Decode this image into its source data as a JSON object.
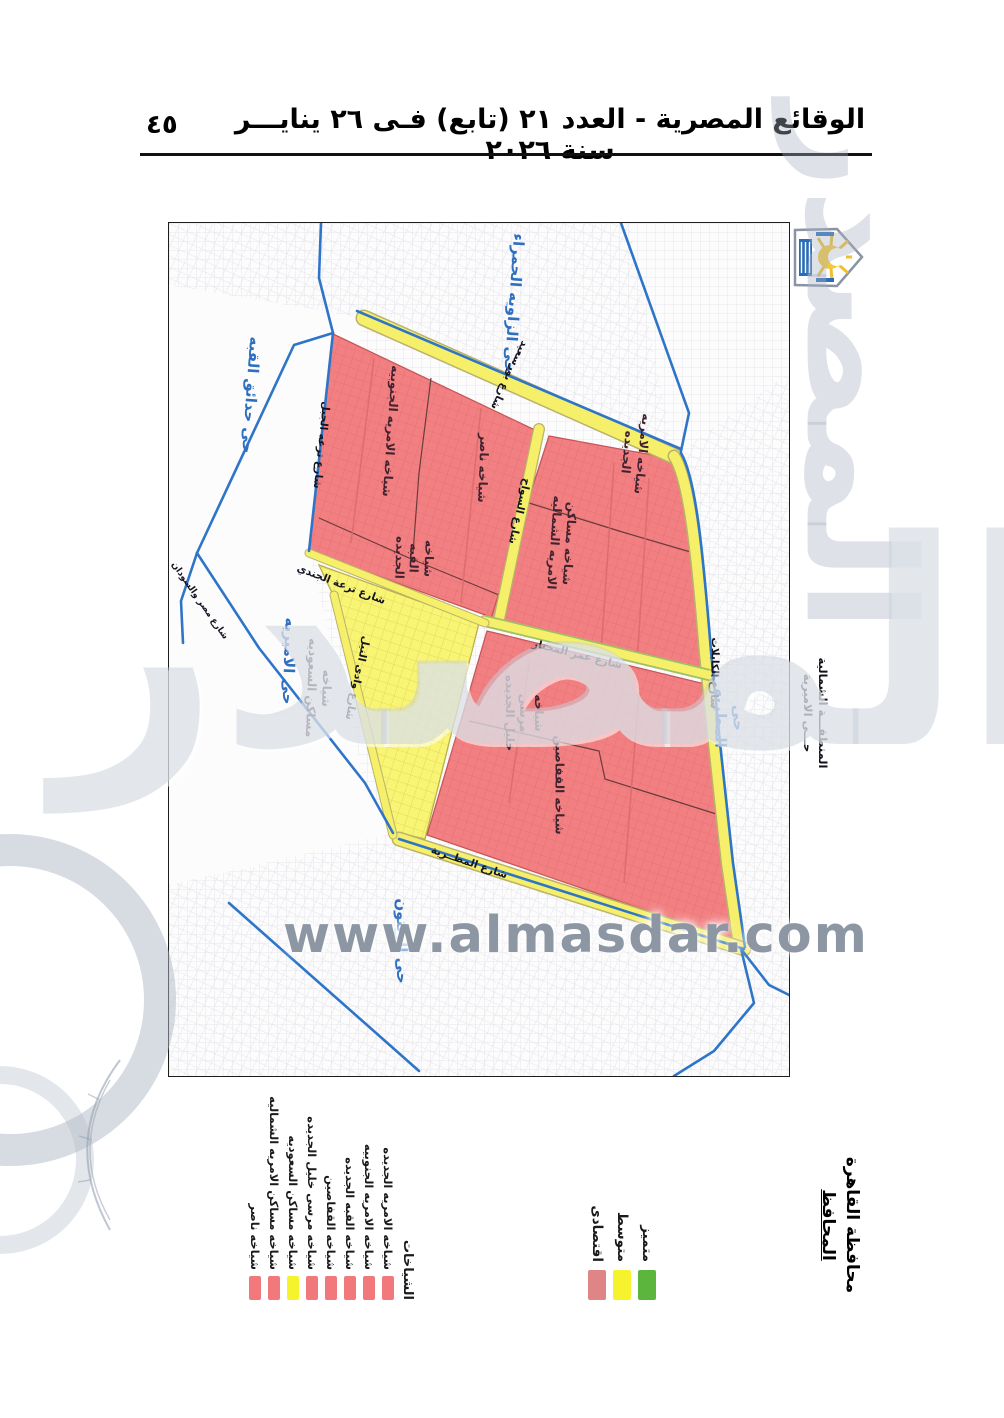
{
  "page": {
    "header_title": "الوقائع المصرية - العدد ٢١ (تابع) فـى ٢٦ ينايـــر سنة ٢٠٢٦",
    "page_number": "٤٥"
  },
  "map": {
    "district_labels": [
      {
        "text": "حى الزاويه الحمراء"
      },
      {
        "text": "حى حدائق القبه"
      },
      {
        "text": "حى الاميريه"
      },
      {
        "text": "حى المطريه"
      },
      {
        "text": "حى الزيتون"
      }
    ],
    "zone_labels": [
      {
        "text": "شياخه الامريه الجنوبيه"
      },
      {
        "text": "شياخه ناصر"
      },
      {
        "text": "شياخه\nالقبه\nالجديده"
      },
      {
        "text": "شياخه الامريه\nالجديده"
      },
      {
        "text": "شياخه مساكن\nالامريه الشماليه"
      },
      {
        "text": "شياخه\nمرسى\nخليل الجديده"
      },
      {
        "text": "شياخه القفاصين"
      },
      {
        "text": "شياخه\nمساكن السعوديه"
      }
    ],
    "street_labels": [
      {
        "text": "شارع بورسعيد"
      },
      {
        "text": "شارع السواح"
      },
      {
        "text": "شارع عمر المختار"
      },
      {
        "text": "شارع ترعه الجبل"
      },
      {
        "text": "شارع ترعة الجندي"
      },
      {
        "text": "شارع وادى النيل"
      },
      {
        "text": "شارع المطــرية"
      },
      {
        "text": "شارع الكابلات"
      },
      {
        "text": "شارع مصر والسودان"
      }
    ],
    "outside_label": "المنطقـــة الشمالية\nحـــى الاميرية"
  },
  "watermark": {
    "url": "www.almasdar.com",
    "big": "المصدر"
  },
  "legend_shiakhat": {
    "title": "الشياخات",
    "items": [
      {
        "label": "شياخه الامريه الجديده",
        "color": "#f2797b"
      },
      {
        "label": "شياخه الامريه الجنوبيه",
        "color": "#f2797b"
      },
      {
        "label": "شياخه القبه الجديده",
        "color": "#f2797b"
      },
      {
        "label": "شياخه القفاصين",
        "color": "#f2797b"
      },
      {
        "label": "شياخه مرسى خليل الجديده",
        "color": "#f2797b"
      },
      {
        "label": "شياخه مساكن السعوديه",
        "color": "#f5f32b"
      },
      {
        "label": "شياخه مساكن الامريه الشماليه",
        "color": "#f2797b"
      },
      {
        "label": "شياخه ناصر",
        "color": "#f2797b"
      }
    ]
  },
  "legend_levels": {
    "items": [
      {
        "label": "متميز",
        "color": "#5cb53c"
      },
      {
        "label": "متوسط",
        "color": "#f6f22e"
      },
      {
        "label": "اقتصادى",
        "color": "#e08585"
      }
    ]
  },
  "signature": {
    "line1": "محافظة القاهرة",
    "line2": "المحافظ"
  }
}
